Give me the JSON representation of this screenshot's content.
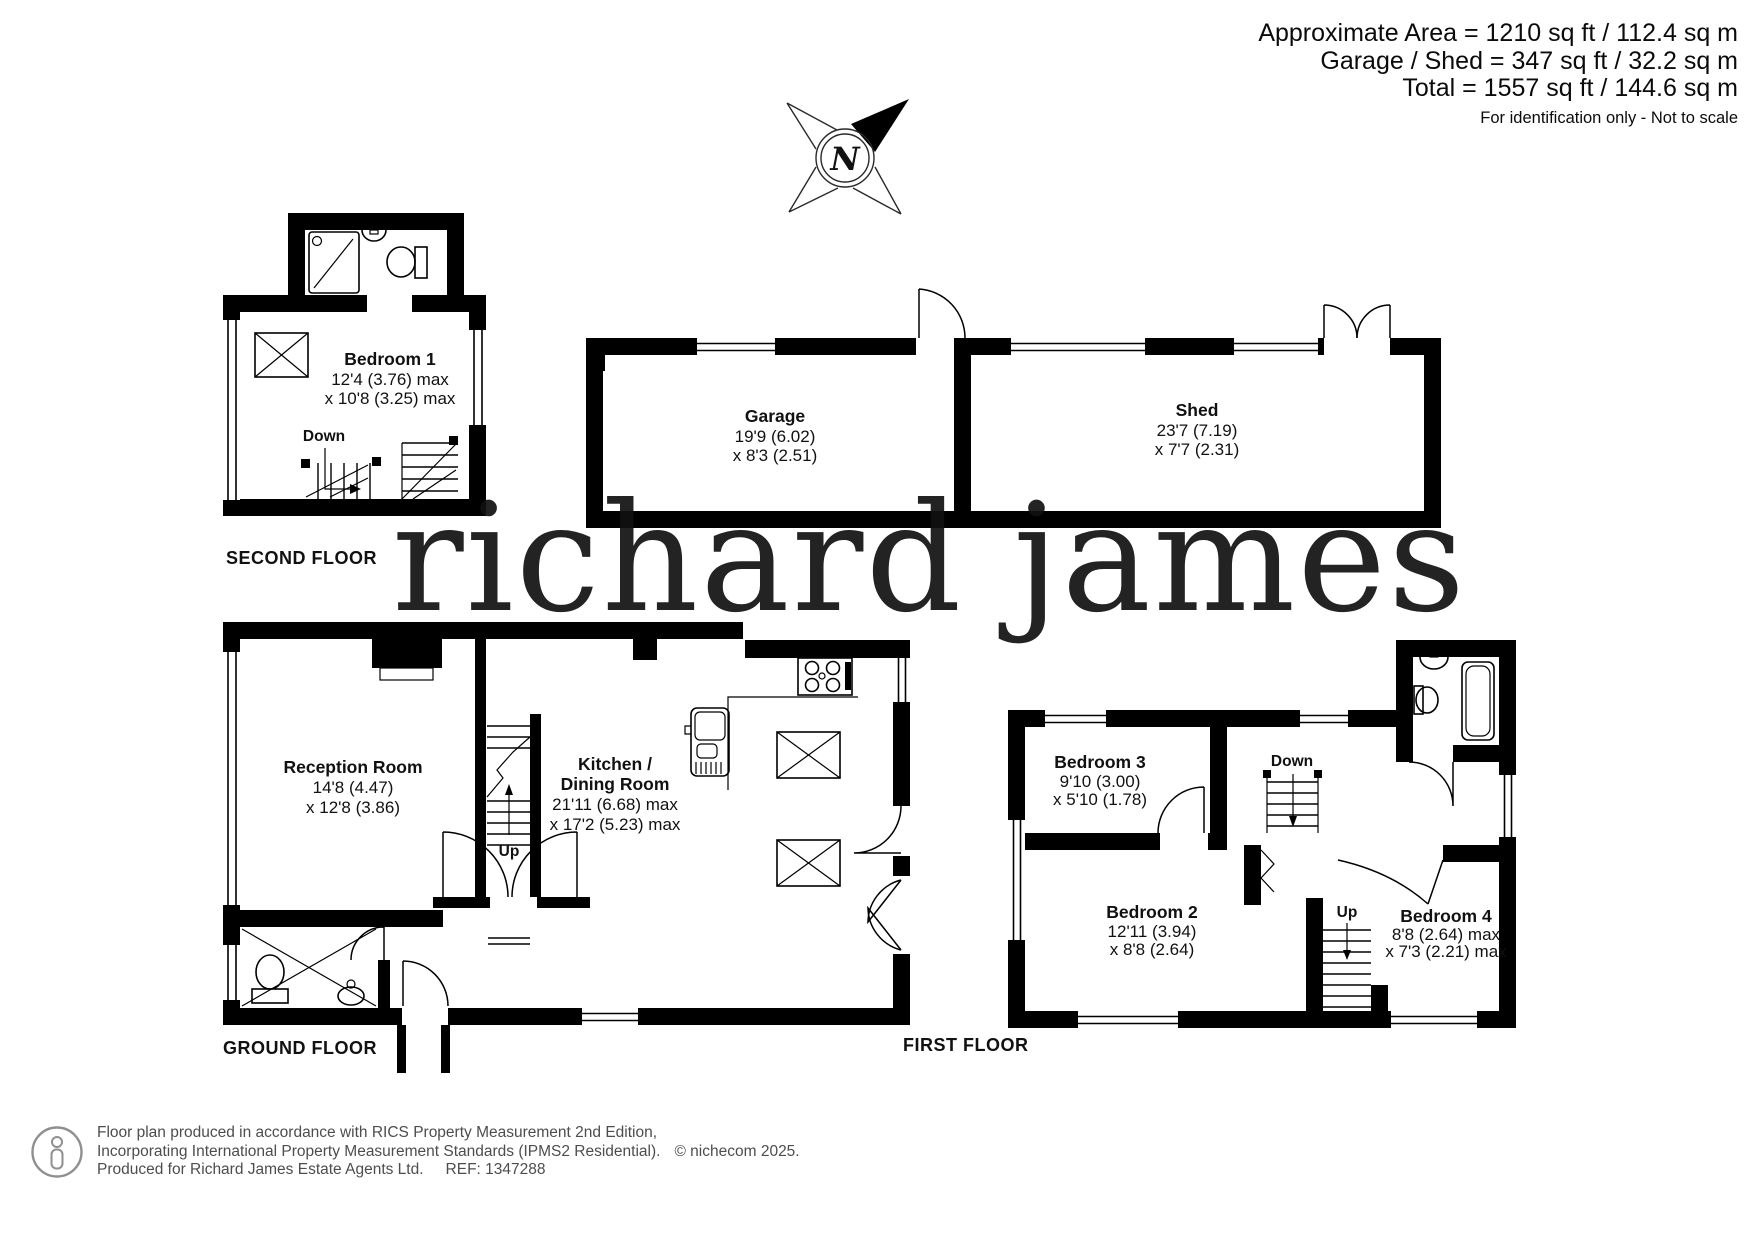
{
  "header": {
    "area_line1": "Approximate Area = 1210 sq ft / 112.4 sq m",
    "area_line2": "Garage / Shed = 347 sq ft / 32.2 sq m",
    "area_line3": "Total = 1557 sq ft / 144.6 sq m",
    "disclaimer": "For identification only - Not to scale"
  },
  "compass": {
    "label": "N"
  },
  "watermark": {
    "text": "richard james",
    "color": "#f1dfb8"
  },
  "second_floor": {
    "label": "SECOND FLOOR",
    "room": {
      "name": "Bedroom 1",
      "dim1": "12'4 (3.76) max",
      "dim2": "x 10'8 (3.25) max"
    },
    "stair": "Down"
  },
  "outbuildings": {
    "garage": {
      "name": "Garage",
      "dim1": "19'9 (6.02)",
      "dim2": "x 8'3 (2.51)"
    },
    "shed": {
      "name": "Shed",
      "dim1": "23'7 (7.19)",
      "dim2": "x 7'7 (2.31)"
    }
  },
  "ground_floor": {
    "label": "GROUND FLOOR",
    "reception": {
      "name": "Reception Room",
      "dim1": "14'8 (4.47)",
      "dim2": "x 12'8 (3.86)"
    },
    "kitchen": {
      "name": "Kitchen /",
      "name2": "Dining Room",
      "dim1": "21'11 (6.68) max",
      "dim2": "x 17'2 (5.23) max"
    },
    "stair": "Up"
  },
  "first_floor": {
    "label": "FIRST FLOOR",
    "bedroom3": {
      "name": "Bedroom 3",
      "dim1": "9'10 (3.00)",
      "dim2": "x 5'10 (1.78)"
    },
    "bedroom2": {
      "name": "Bedroom 2",
      "dim1": "12'11 (3.94)",
      "dim2": "x 8'8 (2.64)"
    },
    "bedroom4": {
      "name": "Bedroom 4",
      "dim1": "8'8 (2.64) max",
      "dim2": "x 7'3 (2.21) max"
    },
    "stair_down": "Down",
    "stair_up": "Up"
  },
  "footer": {
    "line1": "Floor plan produced in accordance with RICS Property Measurement 2nd Edition,",
    "line2": "Incorporating International Property Measurement Standards (IPMS2 Residential).",
    "copyright": "© nichecom 2025.",
    "line3": "Produced for Richard James Estate Agents Ltd.",
    "ref": "REF: 1347288"
  }
}
